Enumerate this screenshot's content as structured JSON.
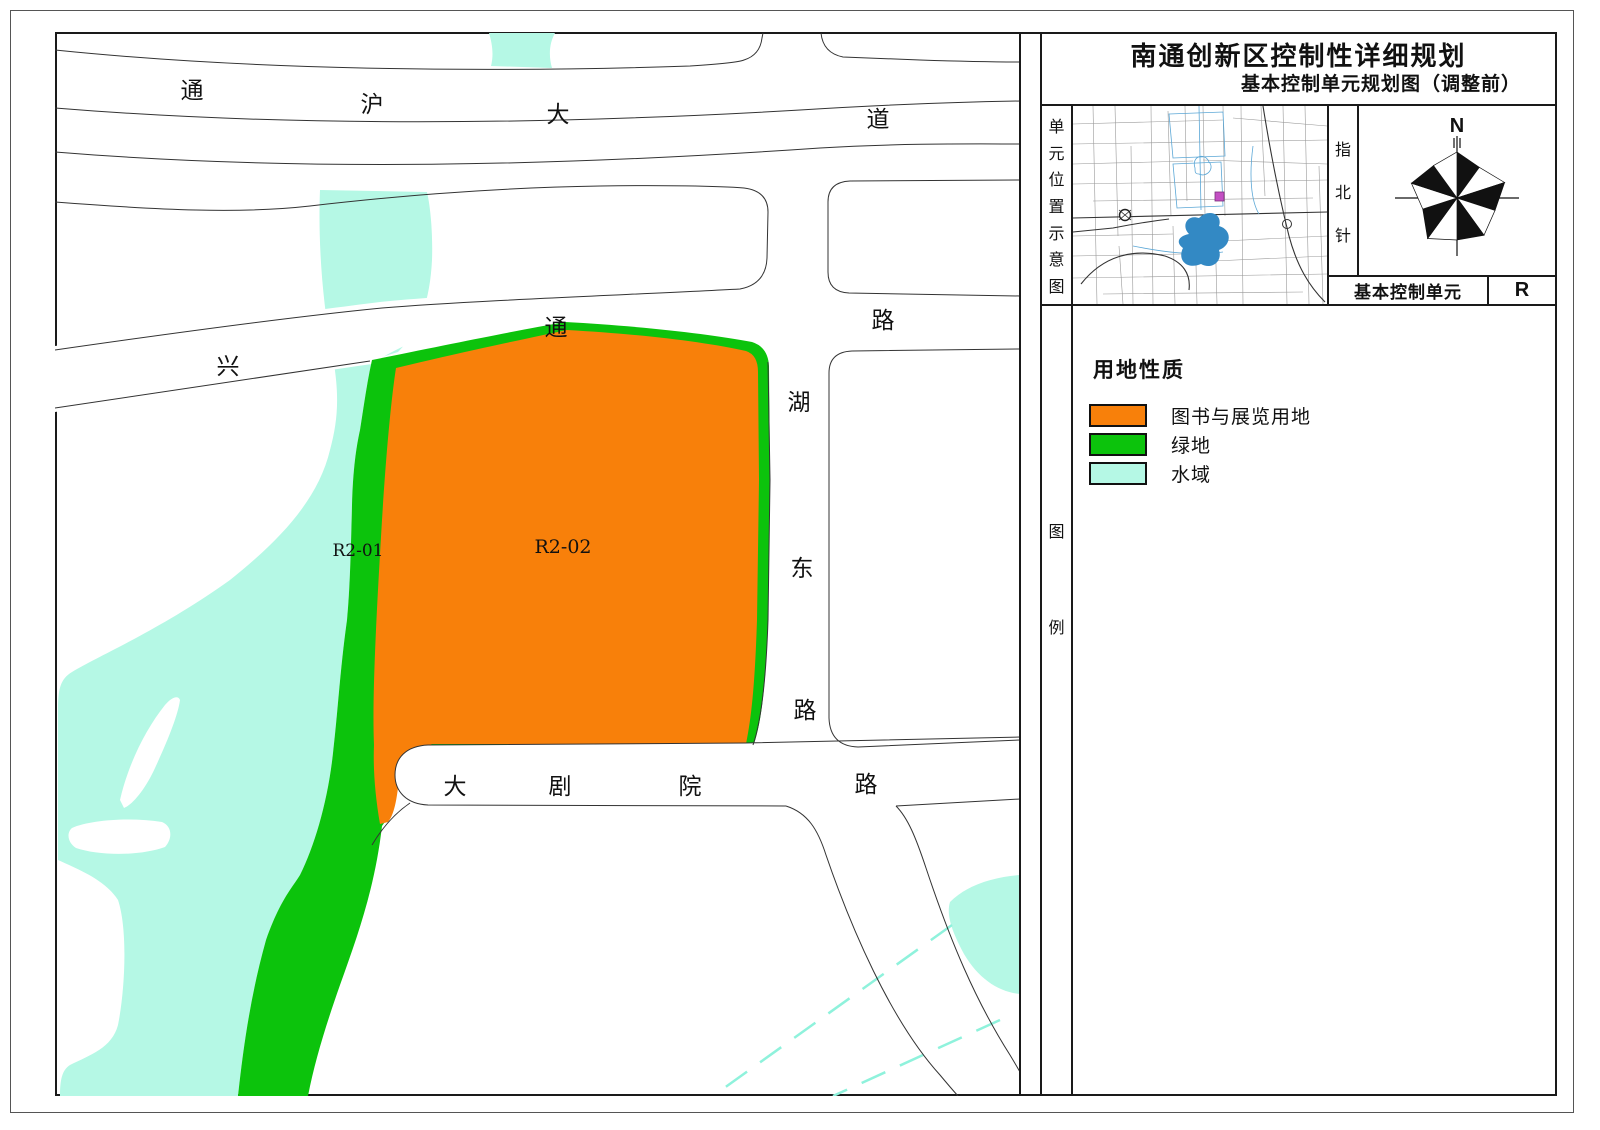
{
  "title": {
    "line1": "南通创新区控制性详细规划",
    "line2": "基本控制单元规划图（调整前）"
  },
  "panel": {
    "location_strip": [
      "单",
      "元",
      "位",
      "置",
      "示",
      "意",
      "图"
    ],
    "north_strip": [
      "指",
      "北",
      "针"
    ],
    "compass_north": "N",
    "unit_row": {
      "label": "基本控制单元",
      "value": "R"
    },
    "legend_strip": [
      "图",
      "例"
    ],
    "legend": {
      "heading": "用地性质",
      "items": [
        {
          "label": "图书与展览用地",
          "color": "#F8800A"
        },
        {
          "label": "绿地",
          "color": "#0CC30C"
        },
        {
          "label": "水域",
          "color": "#B5F8E5"
        }
      ]
    }
  },
  "map": {
    "colors": {
      "library_exhibition": "#F8800A",
      "green_space": "#0CC30C",
      "water": "#B5F8E5",
      "water_dashed_line": "#8FF2DC",
      "road_line": "#333333",
      "inset_lake": "#3389C4",
      "inset_marker": "#C34FC3"
    },
    "road_labels": [
      {
        "name": "通沪大道",
        "chars": [
          "通",
          "沪",
          "大",
          "道"
        ]
      },
      {
        "name": "兴通路",
        "chars": [
          "兴",
          "通",
          "路"
        ]
      },
      {
        "name": "湖东路",
        "chars": [
          "湖",
          "东",
          "路"
        ]
      },
      {
        "name": "大剧院路",
        "chars": [
          "大",
          "剧",
          "院",
          "路"
        ]
      }
    ],
    "parcel_labels": [
      {
        "id": "R2-01",
        "land_use": "绿地"
      },
      {
        "id": "R2-02",
        "land_use": "图书与展览用地"
      }
    ]
  }
}
